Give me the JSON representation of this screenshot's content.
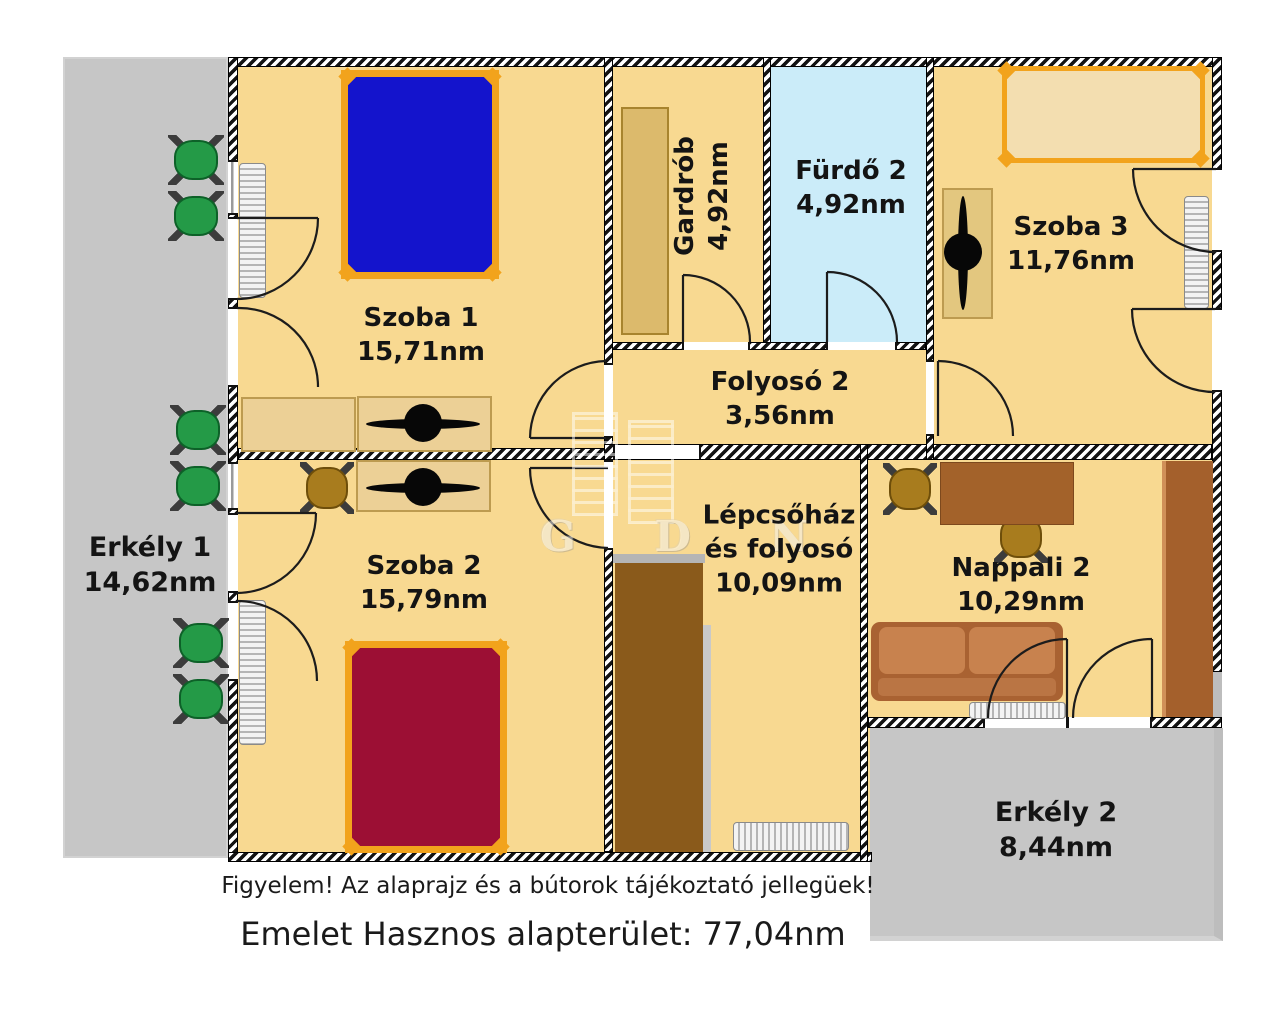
{
  "rooms": {
    "szoba1": {
      "name": "Szoba 1",
      "area": "15,71nm"
    },
    "szoba2": {
      "name": "Szoba 2",
      "area": "15,79nm"
    },
    "szoba3": {
      "name": "Szoba 3",
      "area": "11,76nm"
    },
    "gardrob": {
      "name": "Gardrób",
      "area": "4,92nm"
    },
    "furdo2": {
      "name": "Fürdő 2",
      "area": "4,92nm"
    },
    "folyoso2": {
      "name": "Folyosó 2",
      "area": "3,56nm"
    },
    "lepcsohaz": {
      "name_line1": "Lépcsőház",
      "name_line2": "és folyosó",
      "area": "10,09nm"
    },
    "nappali2": {
      "name": "Nappali 2",
      "area": "10,29nm"
    },
    "erkely1": {
      "name": "Erkély 1",
      "area": "14,62nm"
    },
    "erkely2": {
      "name": "Erkély 2",
      "area": "8,44nm"
    }
  },
  "annotations": {
    "disclaimer": "Figyelem! Az alaprajz és a bútorok tájékoztató jellegüek!",
    "total": "Emelet Hasznos alapterület: 77,04nm"
  },
  "watermark": {
    "letters": "G D N"
  },
  "colors": {
    "floor": "#f8d991",
    "bath_floor": "#cbecf9",
    "wall": "#131313",
    "balcony_gray": "#c6c6c6",
    "accent_orange": "#f2a31c",
    "bed_blue": "#1414cc",
    "bed_red": "#9c0f34",
    "stair_brown": "#8a5a1b",
    "sofa_brown": "#a96232",
    "furniture_brown": "#a3622a",
    "desk_tan": "#ecd096",
    "chair_green": "#249a47",
    "chair_brown": "#a87c1e"
  }
}
